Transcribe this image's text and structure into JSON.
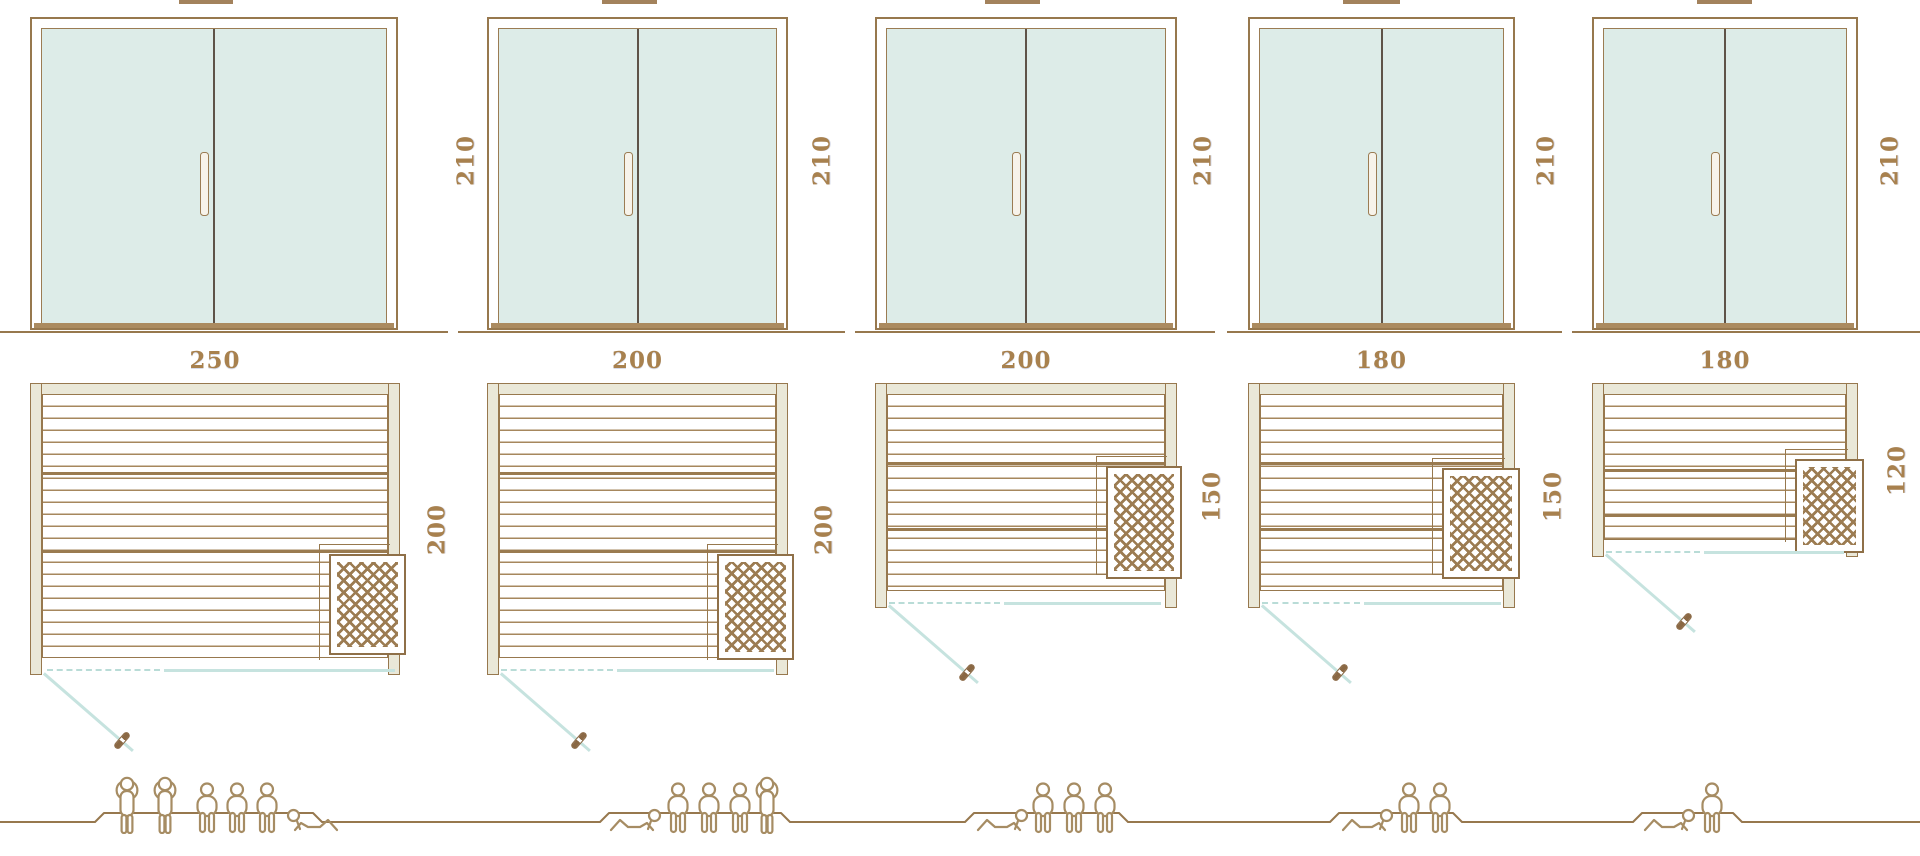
{
  "colors": {
    "line": "#97784e",
    "line_dark": "#5e5348",
    "label_text": "#a8814e",
    "glass": "#ddece8",
    "frame_fill": "#eae8d8",
    "threshold": "#ab8b60",
    "teal_line": "#c6e3df",
    "people_line": "#a68c63",
    "plank_line": "#a6875d",
    "lattice": "#9c7c52"
  },
  "icons": {
    "person_standing": "standing-person-icon",
    "person_sitting": "sitting-person-icon",
    "person_reclining": "reclining-person-icon",
    "heater": "sauna-heater-lattice-icon",
    "door_swing": "door-swing-arc-line",
    "door_handle": "door-handle-icon"
  },
  "columns": [
    {
      "door": {
        "height_label": "210",
        "x": 30,
        "w": 368,
        "label_cx": 466
      },
      "roof": {
        "x": 179,
        "w": 54
      },
      "ground": [
        0,
        448
      ],
      "plan": {
        "width_label": "250",
        "depth_label": "200",
        "x": 30,
        "w": 370,
        "h": 292,
        "dl_cx": 437,
        "heater": {
          "x": 286,
          "y": 159,
          "w": 61,
          "h": 85
        },
        "bench": "corner",
        "bench_xy": [
          276,
          149
        ],
        "heavy": [
          77,
          155
        ],
        "opening": {
          "y": 669,
          "dash": [
            47,
            160
          ],
          "solid": [
            164,
            395
          ]
        },
        "swing": {
          "x": 44,
          "y": 672
        }
      },
      "people": {
        "count": 6,
        "platform": [
          95,
          322
        ],
        "figures": [
          {
            "type": "standing",
            "x": 114
          },
          {
            "type": "standing",
            "x": 152
          },
          {
            "type": "sitting",
            "x": 192
          },
          {
            "type": "sitting",
            "x": 222
          },
          {
            "type": "sitting",
            "x": 252
          },
          {
            "type": "reclining",
            "x": 282,
            "flip": true
          }
        ]
      }
    },
    {
      "door": {
        "height_label": "210",
        "x": 487,
        "w": 301,
        "label_cx": 822
      },
      "roof": {
        "x": 602,
        "w": 55
      },
      "ground": [
        458,
        845
      ],
      "plan": {
        "width_label": "200",
        "depth_label": "200",
        "x": 487,
        "w": 301,
        "h": 292,
        "dl_cx": 824,
        "heater": {
          "x": 217,
          "y": 159,
          "w": 61,
          "h": 90
        },
        "bench": "corner",
        "bench_xy": [
          207,
          149
        ],
        "heavy": [
          77,
          155
        ],
        "opening": {
          "y": 669,
          "dash": [
            501,
            613
          ],
          "solid": [
            617,
            774
          ]
        },
        "swing": {
          "x": 501,
          "y": 672
        }
      },
      "people": {
        "count": 5,
        "platform": [
          600,
          790
        ],
        "figures": [
          {
            "type": "reclining",
            "x": 608
          },
          {
            "type": "sitting",
            "x": 663
          },
          {
            "type": "sitting",
            "x": 694
          },
          {
            "type": "sitting",
            "x": 725
          },
          {
            "type": "standing",
            "x": 754
          }
        ]
      }
    },
    {
      "door": {
        "height_label": "210",
        "x": 875,
        "w": 302,
        "label_cx": 1203
      },
      "roof": {
        "x": 985,
        "w": 55
      },
      "ground": [
        855,
        1215
      ],
      "plan": {
        "width_label": "200",
        "depth_label": "150",
        "x": 875,
        "w": 302,
        "h": 225,
        "dl_cx": 1212,
        "heater": {
          "x": 218,
          "y": 71,
          "w": 60,
          "h": 97
        },
        "bench": "mid",
        "bench_xy": [
          208,
          61
        ],
        "heavy": [
          67,
          133
        ],
        "opening": {
          "y": 602,
          "dash": [
            889,
            1000
          ],
          "solid": [
            1004,
            1161
          ]
        },
        "swing": {
          "x": 889,
          "y": 604
        }
      },
      "people": {
        "count": 4,
        "platform": [
          965,
          1128
        ],
        "figures": [
          {
            "type": "reclining",
            "x": 975
          },
          {
            "type": "sitting",
            "x": 1028
          },
          {
            "type": "sitting",
            "x": 1059
          },
          {
            "type": "sitting",
            "x": 1090
          }
        ]
      }
    },
    {
      "door": {
        "height_label": "210",
        "x": 1248,
        "w": 267,
        "label_cx": 1546
      },
      "roof": {
        "x": 1343,
        "w": 57
      },
      "ground": [
        1227,
        1562
      ],
      "plan": {
        "width_label": "180",
        "depth_label": "150",
        "x": 1248,
        "w": 267,
        "h": 225,
        "dl_cx": 1553,
        "heater": {
          "x": 181,
          "y": 73,
          "w": 62,
          "h": 95
        },
        "bench": "mid",
        "bench_xy": [
          171,
          63
        ],
        "heavy": [
          67,
          133
        ],
        "opening": {
          "y": 602,
          "dash": [
            1262,
            1360
          ],
          "solid": [
            1364,
            1501
          ]
        },
        "swing": {
          "x": 1262,
          "y": 604
        }
      },
      "people": {
        "count": 3,
        "platform": [
          1330,
          1462
        ],
        "figures": [
          {
            "type": "reclining",
            "x": 1340
          },
          {
            "type": "sitting",
            "x": 1394
          },
          {
            "type": "sitting",
            "x": 1425
          }
        ]
      }
    },
    {
      "door": {
        "height_label": "210",
        "x": 1592,
        "w": 266,
        "label_cx": 1890
      },
      "roof": {
        "x": 1697,
        "w": 55
      },
      "ground": [
        1572,
        1920
      ],
      "plan": {
        "width_label": "180",
        "depth_label": "120",
        "x": 1592,
        "w": 266,
        "h": 174,
        "dl_cx": 1897,
        "heater": {
          "x": 190,
          "y": 64,
          "w": 53,
          "h": 78
        },
        "bench": "corner",
        "bench_xy": [
          180,
          54
        ],
        "heavy": [
          74,
          119
        ],
        "opening": {
          "y": 551,
          "dash": [
            1606,
            1700
          ],
          "solid": [
            1704,
            1844
          ]
        },
        "swing": {
          "x": 1606,
          "y": 553
        }
      },
      "people": {
        "count": 2,
        "platform": [
          1633,
          1742
        ],
        "figures": [
          {
            "type": "reclining",
            "x": 1642
          },
          {
            "type": "sitting",
            "x": 1697
          }
        ]
      }
    }
  ]
}
